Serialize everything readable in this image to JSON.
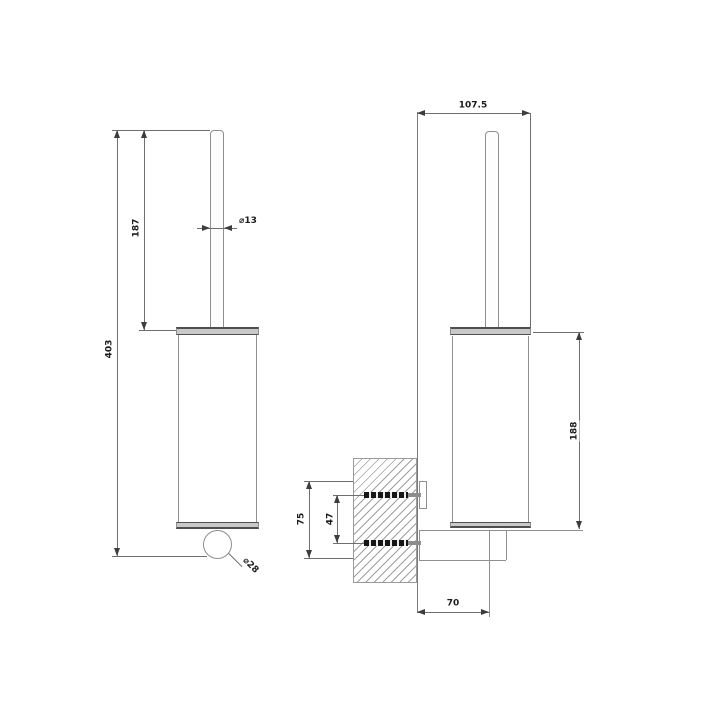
{
  "drawing": {
    "front_view": {
      "overall_height": "403",
      "handle_length": "187",
      "handle_diameter": "⌀13",
      "knob_diameter": "⌀28"
    },
    "side_view": {
      "depth_from_wall": "107.5",
      "body_height": "188",
      "fixture_height": "75",
      "screw_spacing": "47",
      "wall_to_axis": "70"
    }
  }
}
